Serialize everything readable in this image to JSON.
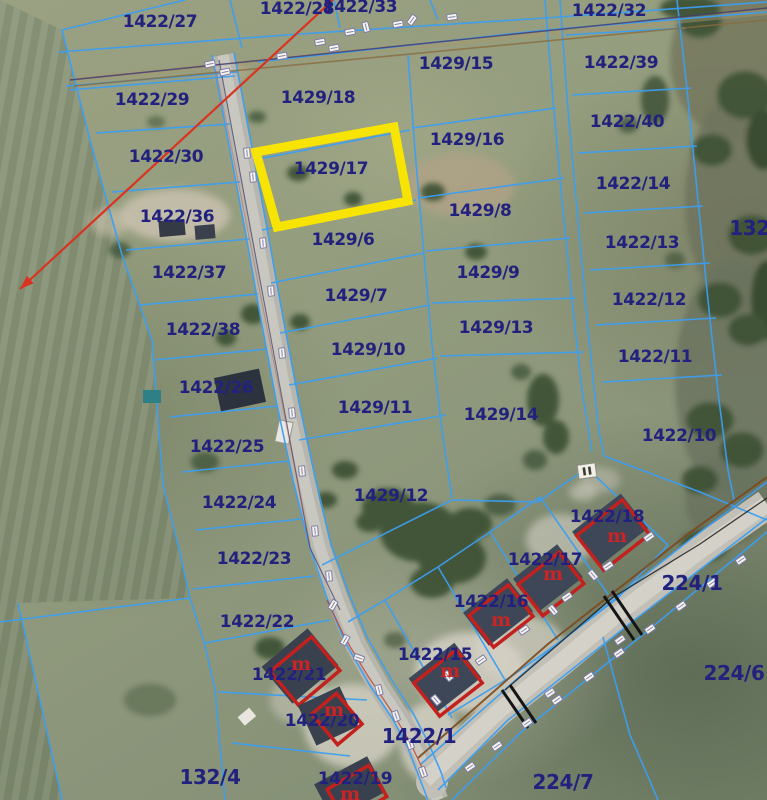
{
  "map": {
    "type": "cadastral-aerial-map",
    "selected_parcel": "1429/17",
    "colors": {
      "line": "#3c9ff2",
      "label": "#22227e",
      "highlight": "#f8e403",
      "building-outline": "#c4201d",
      "building-mark": "#cc2424",
      "survey-line": "#d83420",
      "road-fill": "#b7b6ae"
    },
    "parcels": [
      {
        "label": "1422/27",
        "x": 160,
        "y": 22
      },
      {
        "label": "1422/28",
        "x": 297,
        "y": 9
      },
      {
        "label": "1422/33",
        "x": 360,
        "y": 7
      },
      {
        "label": "1422/32",
        "x": 609,
        "y": 11
      },
      {
        "label": "1429/15",
        "x": 456,
        "y": 64
      },
      {
        "label": "1422/39",
        "x": 621,
        "y": 63
      },
      {
        "label": "1429/18",
        "x": 318,
        "y": 98
      },
      {
        "label": "1422/29",
        "x": 152,
        "y": 100
      },
      {
        "label": "1422/40",
        "x": 627,
        "y": 122
      },
      {
        "label": "1429/16",
        "x": 467,
        "y": 140
      },
      {
        "label": "1422/30",
        "x": 166,
        "y": 157
      },
      {
        "label": "1429/17",
        "x": 331,
        "y": 169
      },
      {
        "label": "1422/14",
        "x": 633,
        "y": 184
      },
      {
        "label": "1429/8",
        "x": 480,
        "y": 211
      },
      {
        "label": "1422/36",
        "x": 177,
        "y": 217
      },
      {
        "label": "132/",
        "x": 753,
        "y": 228,
        "s": "lg"
      },
      {
        "label": "1429/6",
        "x": 343,
        "y": 240
      },
      {
        "label": "1422/13",
        "x": 642,
        "y": 243
      },
      {
        "label": "1429/9",
        "x": 488,
        "y": 273
      },
      {
        "label": "1422/37",
        "x": 189,
        "y": 273
      },
      {
        "label": "1422/12",
        "x": 649,
        "y": 300
      },
      {
        "label": "1429/7",
        "x": 356,
        "y": 296
      },
      {
        "label": "1429/13",
        "x": 496,
        "y": 328
      },
      {
        "label": "1422/38",
        "x": 203,
        "y": 330
      },
      {
        "label": "1429/10",
        "x": 368,
        "y": 350
      },
      {
        "label": "1422/11",
        "x": 655,
        "y": 357
      },
      {
        "label": "1422/26",
        "x": 216,
        "y": 388
      },
      {
        "label": "1429/11",
        "x": 375,
        "y": 408
      },
      {
        "label": "1429/14",
        "x": 501,
        "y": 415
      },
      {
        "label": "1422/10",
        "x": 679,
        "y": 436
      },
      {
        "label": "1422/25",
        "x": 227,
        "y": 447
      },
      {
        "label": "1429/12",
        "x": 391,
        "y": 496
      },
      {
        "label": "1422/24",
        "x": 239,
        "y": 503
      },
      {
        "label": "1422/18",
        "x": 607,
        "y": 517
      },
      {
        "label": "1422/23",
        "x": 254,
        "y": 559
      },
      {
        "label": "1422/17",
        "x": 545,
        "y": 560
      },
      {
        "label": "224/1",
        "x": 692,
        "y": 583,
        "s": "lg"
      },
      {
        "label": "1422/16",
        "x": 491,
        "y": 602
      },
      {
        "label": "1422/22",
        "x": 257,
        "y": 622
      },
      {
        "label": "1422/15",
        "x": 435,
        "y": 655
      },
      {
        "label": "224/6",
        "x": 734,
        "y": 673,
        "s": "lg"
      },
      {
        "label": "1422/21",
        "x": 289,
        "y": 675
      },
      {
        "label": "1422/20",
        "x": 322,
        "y": 721
      },
      {
        "label": "1422/1",
        "x": 419,
        "y": 736,
        "s": "lg"
      },
      {
        "label": "132/4",
        "x": 210,
        "y": 777,
        "s": "lg"
      },
      {
        "label": "1422/19",
        "x": 355,
        "y": 779
      },
      {
        "label": "224/7",
        "x": 563,
        "y": 782,
        "s": "lg"
      }
    ],
    "building_mark_label": "m",
    "building_marks": [
      [
        617,
        536
      ],
      [
        553,
        574
      ],
      [
        501,
        620
      ],
      [
        450,
        671
      ],
      [
        301,
        664
      ],
      [
        334,
        710
      ],
      [
        350,
        794
      ]
    ],
    "utility_markers": [
      [
        210,
        64,
        -12
      ],
      [
        225,
        72,
        -12
      ],
      [
        282,
        56,
        -10
      ],
      [
        320,
        42,
        -10
      ],
      [
        334,
        48,
        -10
      ],
      [
        350,
        32,
        -10
      ],
      [
        366,
        27,
        75
      ],
      [
        398,
        24,
        -10
      ],
      [
        412,
        20,
        -55
      ],
      [
        452,
        17,
        -8
      ],
      [
        247,
        153,
        85
      ],
      [
        253,
        177,
        85
      ],
      [
        263,
        243,
        85
      ],
      [
        271,
        291,
        85
      ],
      [
        282,
        353,
        85
      ],
      [
        292,
        413,
        85
      ],
      [
        302,
        471,
        85
      ],
      [
        315,
        531,
        85
      ],
      [
        329,
        576,
        85
      ],
      [
        333,
        605,
        -60
      ],
      [
        345,
        640,
        -60
      ],
      [
        359,
        658,
        20
      ],
      [
        379,
        690,
        75
      ],
      [
        396,
        716,
        70
      ],
      [
        410,
        744,
        70
      ],
      [
        423,
        772,
        70
      ],
      [
        481,
        660,
        -35
      ],
      [
        524,
        630,
        -35
      ],
      [
        567,
        597,
        -35
      ],
      [
        608,
        566,
        -35
      ],
      [
        649,
        537,
        -35
      ],
      [
        593,
        575,
        50
      ],
      [
        553,
        610,
        50
      ],
      [
        436,
        700,
        50
      ],
      [
        448,
        676,
        50
      ],
      [
        470,
        767,
        -35
      ],
      [
        497,
        746,
        -35
      ],
      [
        527,
        723,
        -35
      ],
      [
        557,
        700,
        -35
      ],
      [
        589,
        677,
        -35
      ],
      [
        619,
        653,
        -35
      ],
      [
        650,
        629,
        -35
      ],
      [
        681,
        606,
        -35
      ],
      [
        712,
        583,
        -35
      ],
      [
        741,
        560,
        -35
      ],
      [
        550,
        693,
        -35
      ],
      [
        620,
        640,
        -35
      ]
    ]
  }
}
